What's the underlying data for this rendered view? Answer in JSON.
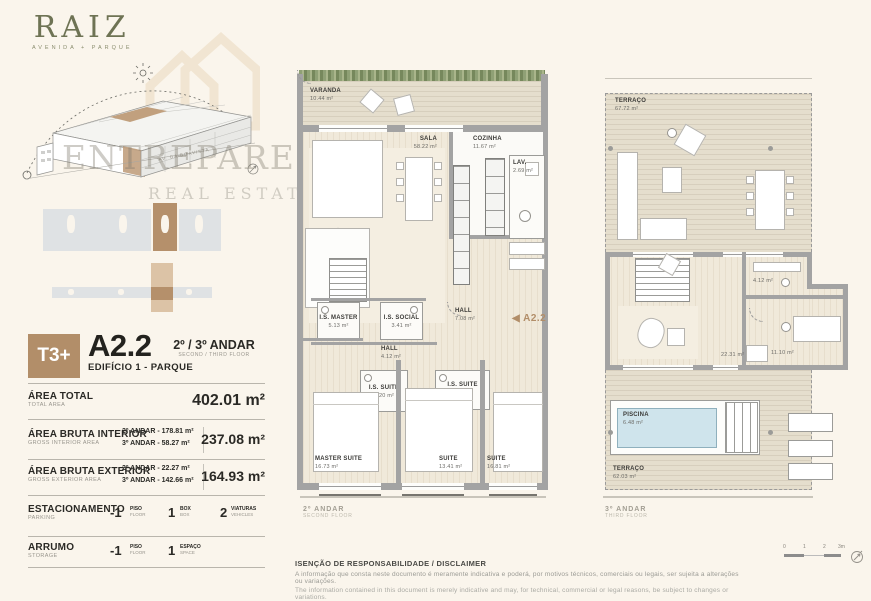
{
  "brand": {
    "logo": "RAIZ",
    "tagline": "AVENIDA + PARQUE",
    "watermark": "ENTREPAREDES",
    "watermark2": "REAL ESTATE",
    "street": "AV. DA BOAVISTA"
  },
  "unit": {
    "typology": "T3+",
    "code": "A2.2",
    "floors": "2º / 3º ANDAR",
    "floors_en": "SECOND / THIRD FLOOR",
    "building": "EDIFÍCIO 1 - PARQUE"
  },
  "areas": {
    "total_label": "ÁREA TOTAL",
    "total_label_en": "TOTAL AREA",
    "total_value": "402.01 m²",
    "interior_label": "ÁREA BRUTA INTERIOR",
    "interior_label_en": "GROSS INTERIOR AREA",
    "interior_line1": "2º ANDAR - 178.81 m²",
    "interior_line2": "3º ANDAR - 58.27 m²",
    "interior_value": "237.08 m²",
    "exterior_label": "ÁREA BRUTA EXTERIOR",
    "exterior_label_en": "GROSS EXTERIOR AREA",
    "exterior_line1": "2º ANDAR - 22.27 m²",
    "exterior_line2": "3º ANDAR - 142.66 m²",
    "exterior_value": "164.93 m²"
  },
  "parking": {
    "label": "ESTACIONAMENTO",
    "label_en": "PARKING",
    "floor_num": "-1",
    "floor_unit": "PISO",
    "floor_unit_en": "FLOOR",
    "box_num": "1",
    "box_unit": "BOX",
    "box_unit_en": "BOX",
    "vehicles_num": "2",
    "vehicles_unit": "VIATURAS",
    "vehicles_unit_en": "VEHICLES"
  },
  "storage": {
    "label": "ARRUMO",
    "label_en": "STORAGE",
    "floor_num": "-1",
    "floor_unit": "PISO",
    "floor_unit_en": "FLOOR",
    "space_num": "1",
    "space_unit": "ESPAÇO",
    "space_unit_en": "SPACE"
  },
  "plan2": {
    "caption": "2º ANDAR",
    "caption_en": "SECOND FLOOR",
    "marker_arrow": "◀",
    "marker_text": "A2.2",
    "rooms": {
      "varanda": {
        "name": "VARANDA",
        "area": "10.44 m²"
      },
      "sala": {
        "name": "SALA",
        "area": "58.22 m²"
      },
      "cozinha": {
        "name": "COZINHA",
        "area": "11.67 m²"
      },
      "lav": {
        "name": "LAV.",
        "area": "2.69 m²"
      },
      "is_master": {
        "name": "I.S. MASTER",
        "area": "5.13 m²"
      },
      "is_social": {
        "name": "I.S. SOCIAL",
        "area": "3.41 m²"
      },
      "hall_upper": {
        "name": "HALL",
        "area": "7.08 m²"
      },
      "hall_lower": {
        "name": "HALL",
        "area": "4.12 m²"
      },
      "is_suite_1": {
        "name": "I.S. SUITE",
        "area": "3.20 m²"
      },
      "is_suite_2": {
        "name": "I.S. SUITE",
        "area": "3.21 m²"
      },
      "master_suite": {
        "name": "MASTER SUITE",
        "area": "16.73 m²"
      },
      "suite_1": {
        "name": "SUITE",
        "area": "13.41 m²"
      },
      "suite_2": {
        "name": "SUITE",
        "area": "16.81 m²"
      }
    }
  },
  "plan3": {
    "caption": "3º ANDAR",
    "caption_en": "THIRD FLOOR",
    "rooms": {
      "terraco_sup": {
        "name": "TERRAÇO",
        "area": "67.72 m²"
      },
      "sala_mezanino": {
        "area": "22.31 m²"
      },
      "is": {
        "area": "4.12 m²"
      },
      "escritorio": {
        "area": "11.10 m²"
      },
      "piscina": {
        "name": "PISCINA",
        "area": "6.48 m²"
      },
      "terraco_inf": {
        "name": "TERRAÇO",
        "area": "62.03 m²"
      }
    }
  },
  "scalebar": {
    "t0": "0",
    "t1": "1",
    "t2": "2",
    "t3": "3m"
  },
  "disclaimer": {
    "title": "ISENÇÃO DE RESPONSABILIDADE / DISCLAIMER",
    "pt": "A informação que consta neste documento é meramente indicativa e poderá, por motivos técnicos, comerciais ou legais, ser sujeita a alterações ou variações.",
    "en": "The information contained in this document is merely indicative and may, for technical, commercial or legal reasons, be subject to changes or variations."
  }
}
